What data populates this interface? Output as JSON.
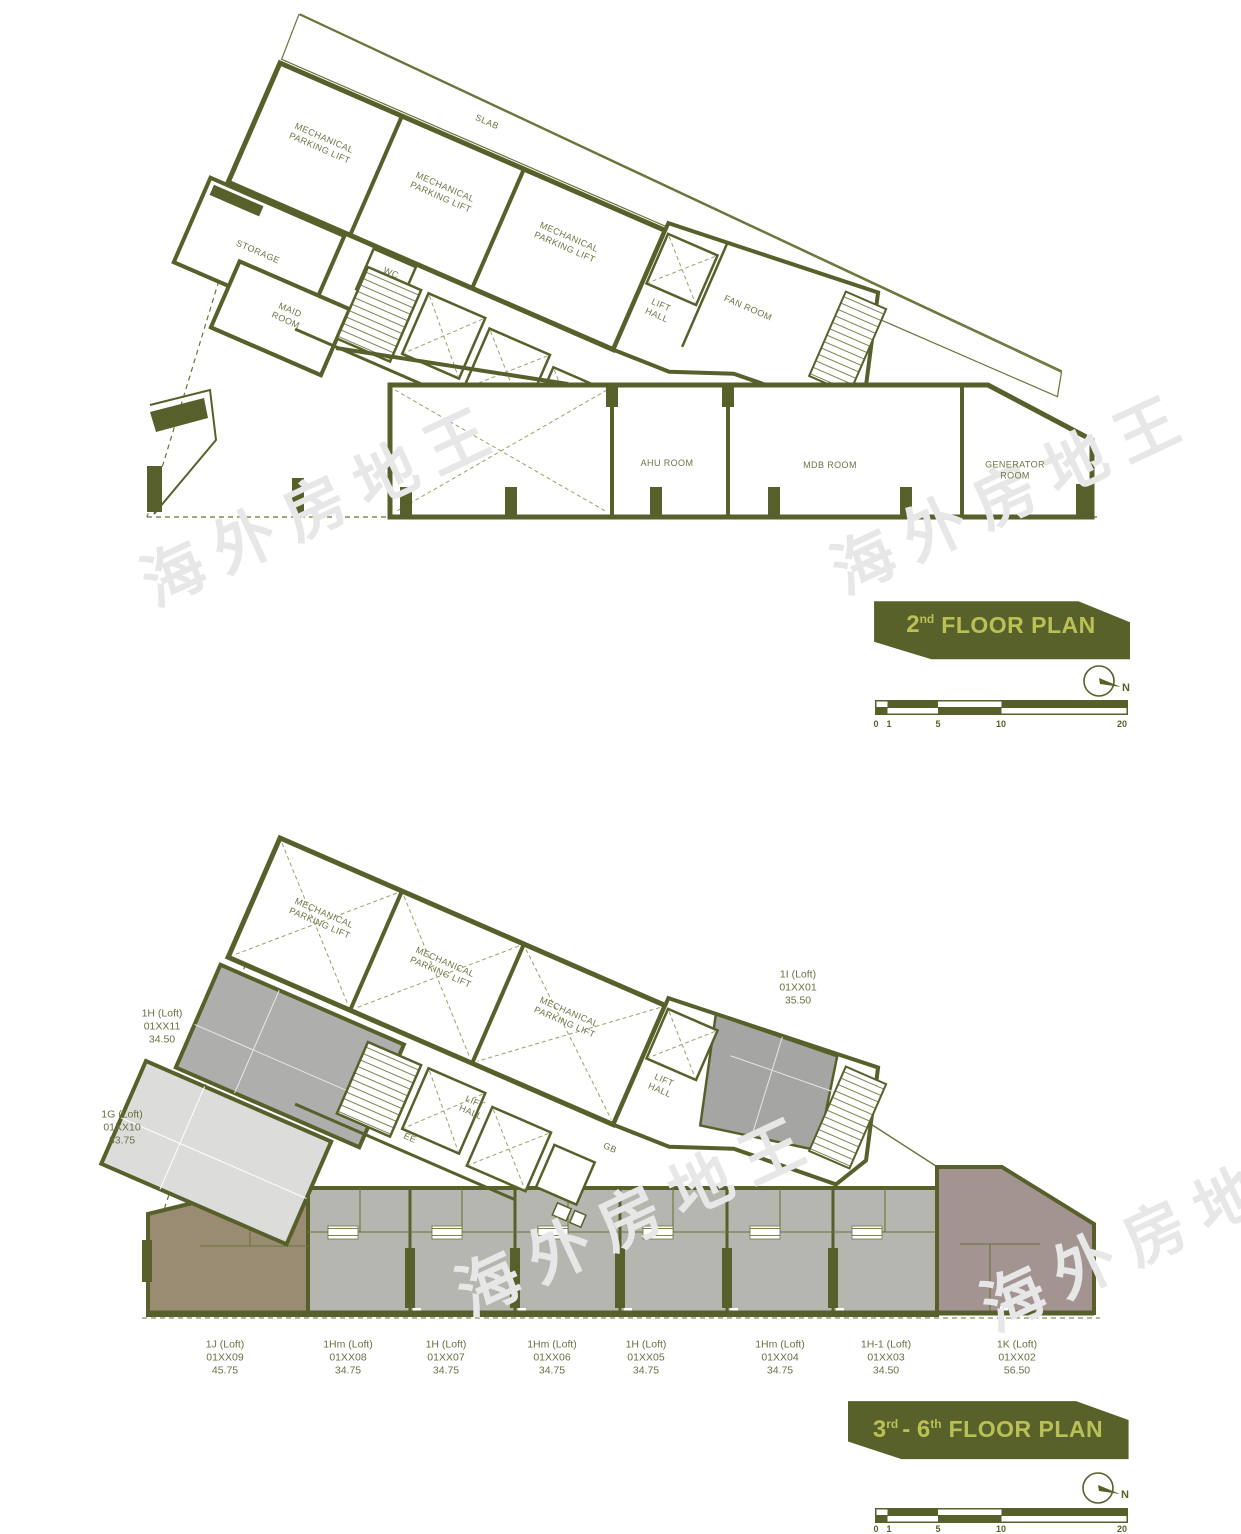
{
  "watermark": {
    "text": "海外房地王"
  },
  "colors": {
    "wall": "#57602a",
    "thin_line": "#6b7339",
    "banner_bg": "#59612a",
    "banner_text": "#b9c156",
    "label_text": "#6f7446",
    "fill_unit_gray": "#aeaeac",
    "fill_unit_light": "#dcdcda",
    "fill_unit_brown": "#9a8c73",
    "fill_unit_mauve": "#a39391",
    "fill_band_gray": "#b5b6b0"
  },
  "plan_2nd": {
    "title": {
      "num": "2",
      "sup": "nd",
      "rest": "FLOOR PLAN"
    },
    "rooms": {
      "slab": "SLAB",
      "mech_parking_1": "MECHANICAL PARKING LIFT",
      "mech_parking_2": "MECHANICAL PARKING LIFT",
      "mech_parking_3": "MECHANICAL PARKING LIFT",
      "storage": "STORAGE",
      "wc": "WC",
      "maid_room": "MAID ROOM",
      "lift_hall": "LIFT HALL",
      "fan_room": "FAN ROOM",
      "ahu_room": "AHU ROOM",
      "mdb_room": "MDB ROOM",
      "generator_room": "GENERATOR ROOM"
    },
    "north": "N",
    "scale": [
      "0",
      "1",
      "5",
      "10",
      "20"
    ]
  },
  "plan_3rd_6th": {
    "title": {
      "num1": "3",
      "sup1": "rd",
      "mid": "- 6",
      "sup2": "th",
      "rest": "FLOOR PLAN"
    },
    "rooms": {
      "mech_parking_1": "MECHANICAL PARKING LIFT",
      "mech_parking_2": "MECHANICAL PARKING LIFT",
      "mech_parking_3": "MECHANICAL PARKING LIFT",
      "lift_hall_center": "LIFT HALL",
      "lift_hall_right": "LIFT HALL",
      "ee": "EE",
      "gb": "GB"
    },
    "units_side": [
      {
        "name": "1H (Loft)",
        "code": "01XX11",
        "area": "34.50"
      },
      {
        "name": "1G (Loft)",
        "code": "01XX10",
        "area": "33.75"
      },
      {
        "name": "1I (Loft)",
        "code": "01XX01",
        "area": "35.50"
      }
    ],
    "units_bottom": [
      {
        "name": "1J (Loft)",
        "code": "01XX09",
        "area": "45.75"
      },
      {
        "name": "1Hm (Loft)",
        "code": "01XX08",
        "area": "34.75"
      },
      {
        "name": "1H (Loft)",
        "code": "01XX07",
        "area": "34.75"
      },
      {
        "name": "1Hm (Loft)",
        "code": "01XX06",
        "area": "34.75"
      },
      {
        "name": "1H (Loft)",
        "code": "01XX05",
        "area": "34.75"
      },
      {
        "name": "1Hm (Loft)",
        "code": "01XX04",
        "area": "34.75"
      },
      {
        "name": "1H-1 (Loft)",
        "code": "01XX03",
        "area": "34.50"
      },
      {
        "name": "1K (Loft)",
        "code": "01XX02",
        "area": "56.50"
      }
    ],
    "north": "N",
    "scale": [
      "0",
      "1",
      "5",
      "10",
      "20"
    ]
  }
}
